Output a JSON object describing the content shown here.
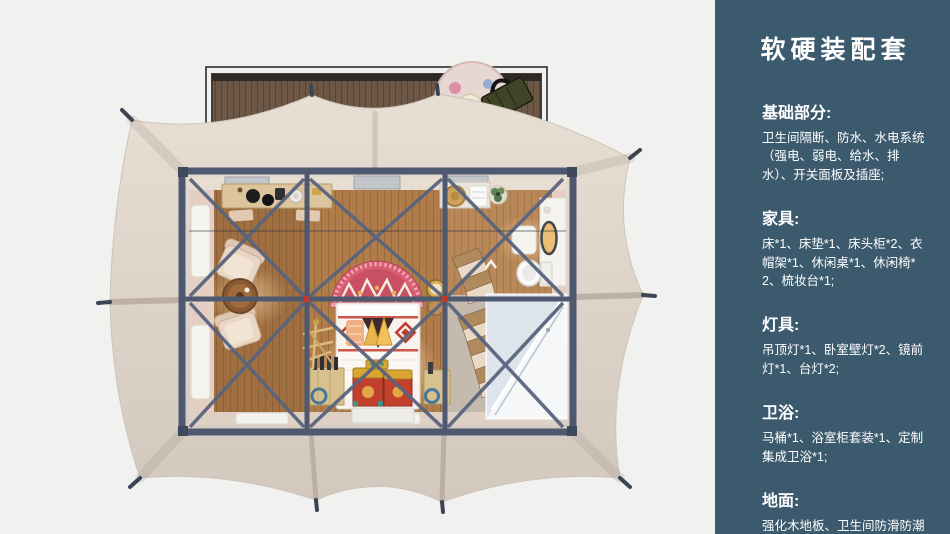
{
  "page": {
    "width": 950,
    "height": 534,
    "background": "#f1f1ef"
  },
  "panel": {
    "background": "#3c5a6d",
    "text_color": "#ffffff",
    "title": "软硬装配套",
    "sections": [
      {
        "heading": "基础部分:",
        "body": "卫生间隔断、防水、水电系统（强电、弱电、给水、排水）、开关面板及插座;"
      },
      {
        "heading": "家具:",
        "body": "床*1、床垫*1、床头柜*2、衣帽架*1、休闲桌*1、休闲椅*2、梳妆台*1;"
      },
      {
        "heading": "灯具:",
        "body": "吊顶灯*1、卧室壁灯*2、镜前灯*1、台灯*2;"
      },
      {
        "heading": "卫浴:",
        "body": "马桶*1、浴室柜套装*1、定制集成卫浴*1;"
      },
      {
        "heading": "地面:",
        "body": "强化木地板、卫生间防滑防潮石塑板;"
      }
    ]
  },
  "floorplan": {
    "view": "top-down-3d-render",
    "colors": {
      "tent_canopy": "#dcd2c8",
      "wood_deck": "#6d5746",
      "steel_frame": "#4e586e",
      "wood_floor": "#b07c4a",
      "accent_red": "#c94f62",
      "chest_red": "#c2402c",
      "chest_gold": "#d8a531",
      "panel_blue": "#3c5a6d"
    },
    "elements": [
      "wooden-deck",
      "deck-rug",
      "picnic-bag",
      "tent-canopy",
      "tent-anchors",
      "steel-frame",
      "ceiling-vents",
      "console-table",
      "armchairs",
      "coffee-table",
      "wall-windows",
      "door-mats",
      "ethnic-headboard-rug",
      "double-bed",
      "storage-chests",
      "bedside-crates",
      "coat-rack",
      "round-mirror-stand",
      "folding-lounge-chairs",
      "bath-console",
      "plant",
      "vanity",
      "vanity-mirror",
      "stool",
      "toilet",
      "shower-enclosure"
    ]
  }
}
